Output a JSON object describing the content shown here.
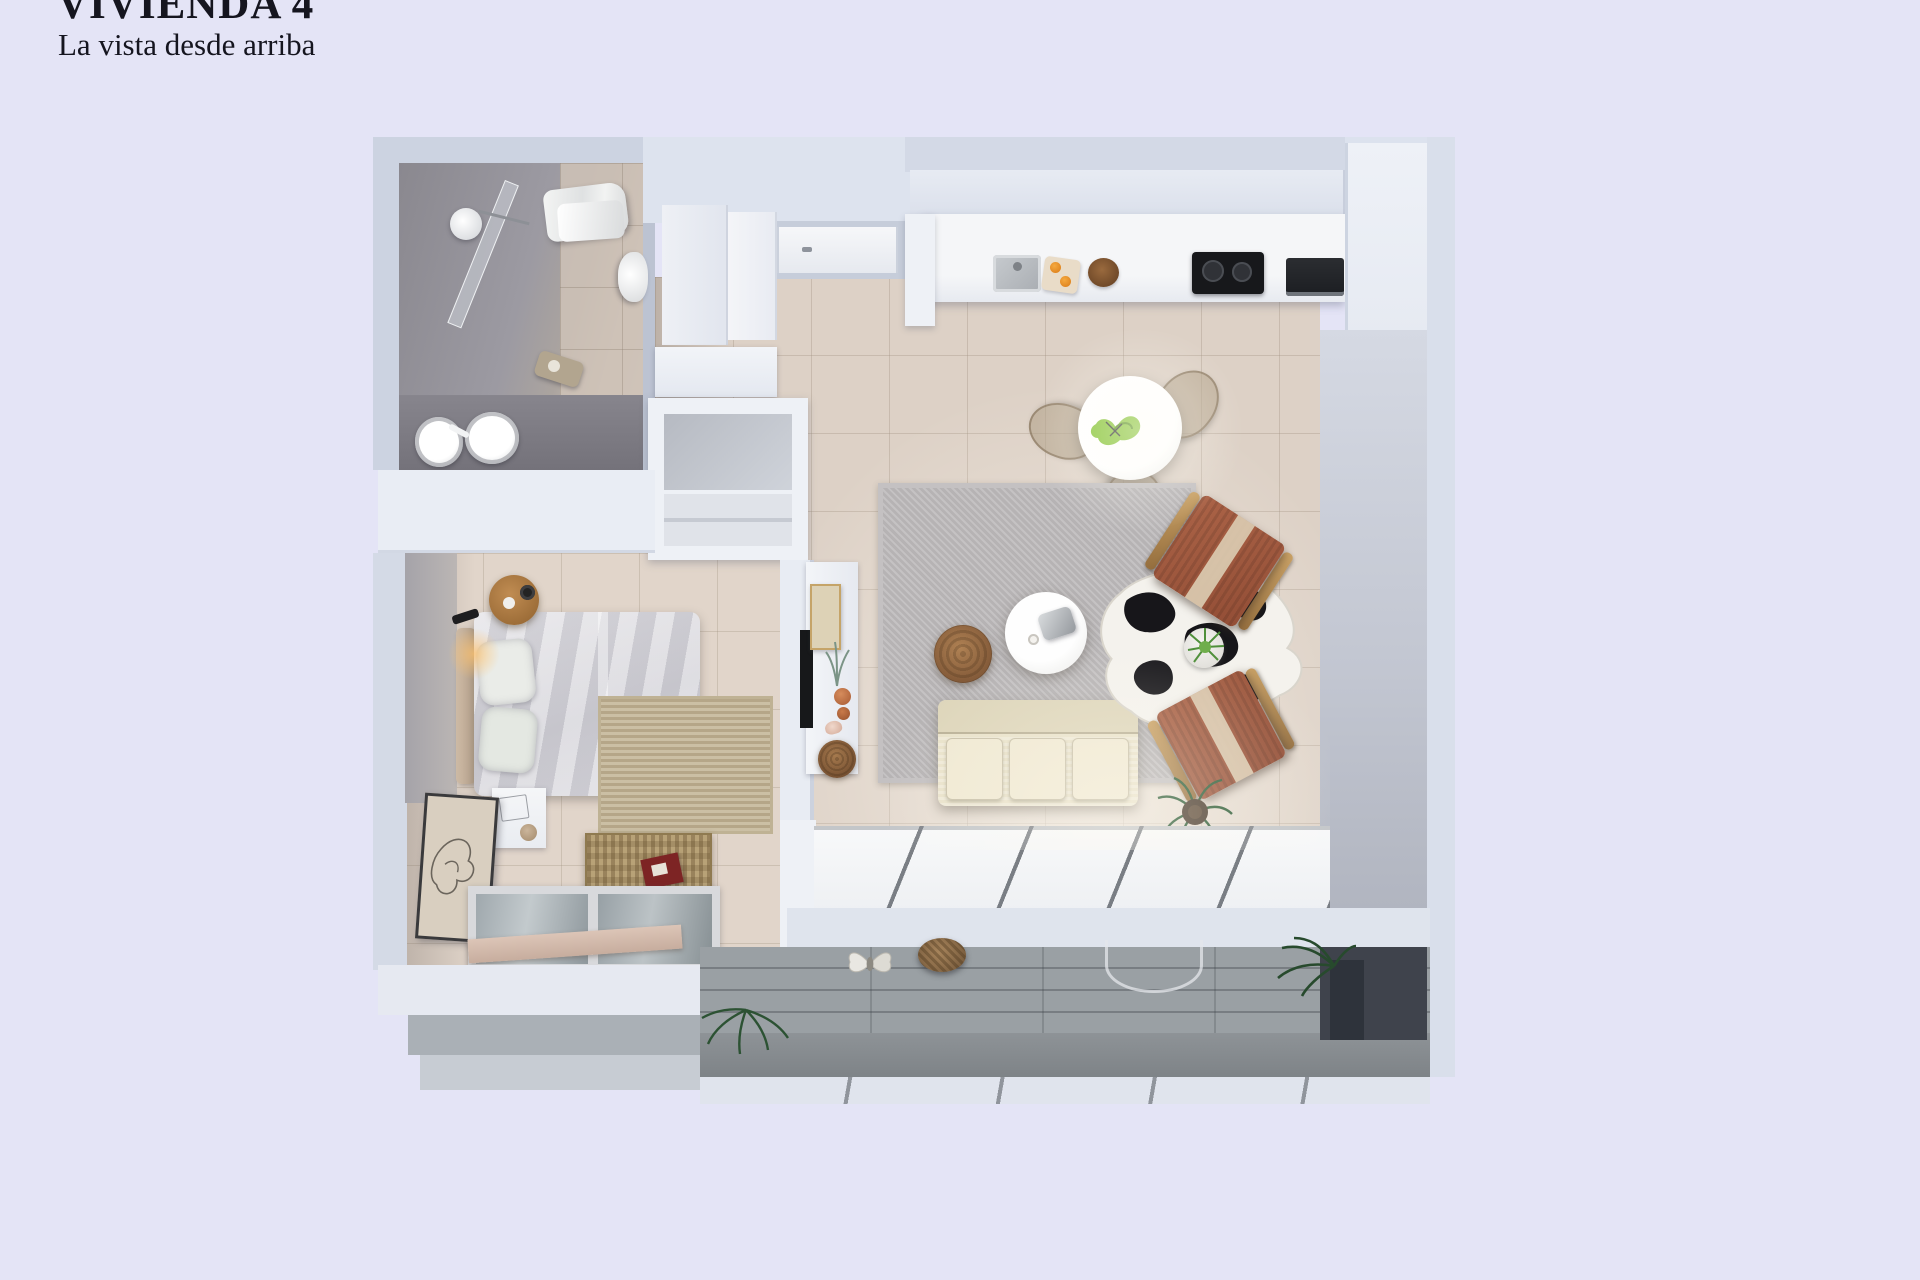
{
  "header": {
    "title": "VIVIENDA 4",
    "subtitle": "La vista desde arriba"
  },
  "palette": {
    "background": "#e4e4f6",
    "wall_light": "#ccd3e1",
    "wall_white": "#e9edf4",
    "floor_tile": "#ddd1c6",
    "bathroom_gray": "#94929a",
    "rug_gray": "#b6b3b4",
    "sofa_cream": "#e9e2ca",
    "armchair_rust": "#a25f43",
    "wood": "#b98d5f",
    "cowhide_black": "#17161a",
    "plant_green": "#8bc63e",
    "terrace_gray": "#9aa0a4",
    "accent_red": "#7d2424"
  },
  "plan": {
    "type": "apartment-top-view-3d-render",
    "rooms": [
      {
        "id": "bathroom",
        "features": [
          "shower",
          "towels",
          "toilet",
          "double-sink-vanity"
        ]
      },
      {
        "id": "entry-hall",
        "features": [
          "front-door",
          "wardrobe-cabinets",
          "console"
        ]
      },
      {
        "id": "kitchen",
        "features": [
          "sink",
          "cutting-board-oranges",
          "bowl",
          "cooktop",
          "oven",
          "tall-cabinets"
        ]
      },
      {
        "id": "living-dining",
        "features": [
          "round-dining-table",
          "three-chairs",
          "gray-rug",
          "coffee-table",
          "wicker-pouf",
          "sofa",
          "two-rust-armchairs",
          "cowhide-rug",
          "plants",
          "tv-console"
        ]
      },
      {
        "id": "bedroom",
        "features": [
          "double-bed",
          "round-nightstand",
          "wall-sconce",
          "white-nightstand",
          "leaning-artwork",
          "jute-rug",
          "wicker-bench",
          "red-book",
          "glass-floor-panel"
        ]
      },
      {
        "id": "terrace",
        "features": [
          "gray-plank-deck",
          "pendant-lamps",
          "plants",
          "white-slab-band"
        ]
      }
    ]
  }
}
